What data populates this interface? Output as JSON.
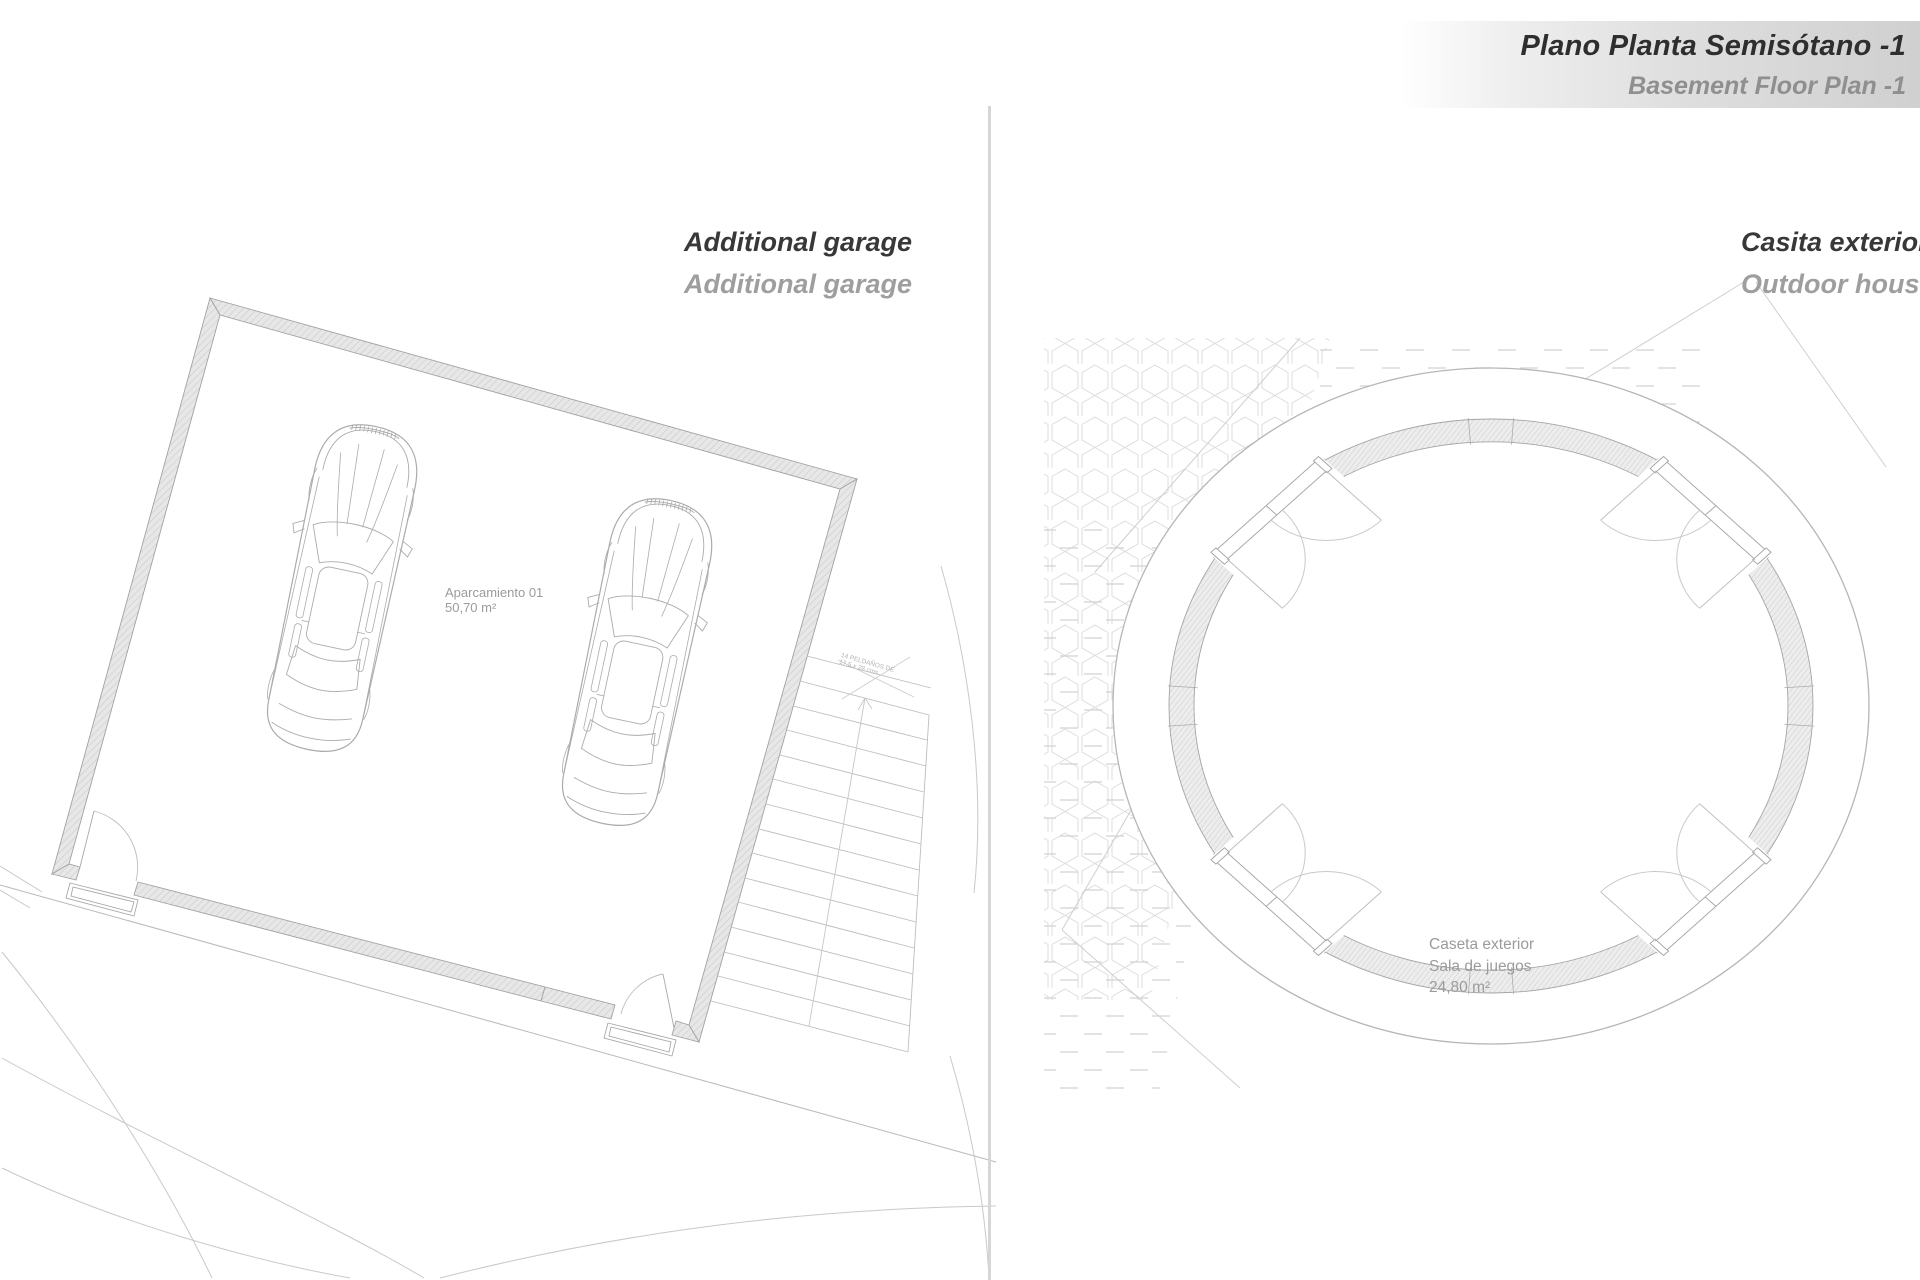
{
  "header": {
    "title": "Plano Planta Semisótano -1",
    "subtitle": "Basement Floor Plan -1"
  },
  "garage_panel": {
    "title": "Additional garage",
    "subtitle": "Additional garage",
    "space_label": {
      "name": "Aparcamiento 01",
      "area": "50,70 m²"
    },
    "stairs_note": {
      "line1": "14 PELDAÑOS DE",
      "line2": "17,5 x 28 cms"
    }
  },
  "house_panel": {
    "title": "Casita exterior",
    "subtitle": "Outdoor house",
    "space_label": {
      "name": "Caseta exterior",
      "use": "Sala de juegos",
      "area": "24,80 m²"
    }
  },
  "colors": {
    "title_dark": "#2e2e2e",
    "title_gray": "#8f8f8f",
    "band_gray": "#d0d0d0",
    "plan_line": "#a8a8a8",
    "wall_fill": "#e6e6e6",
    "label_gray": "#9b9b9b",
    "divider": "#d6d6d6"
  }
}
